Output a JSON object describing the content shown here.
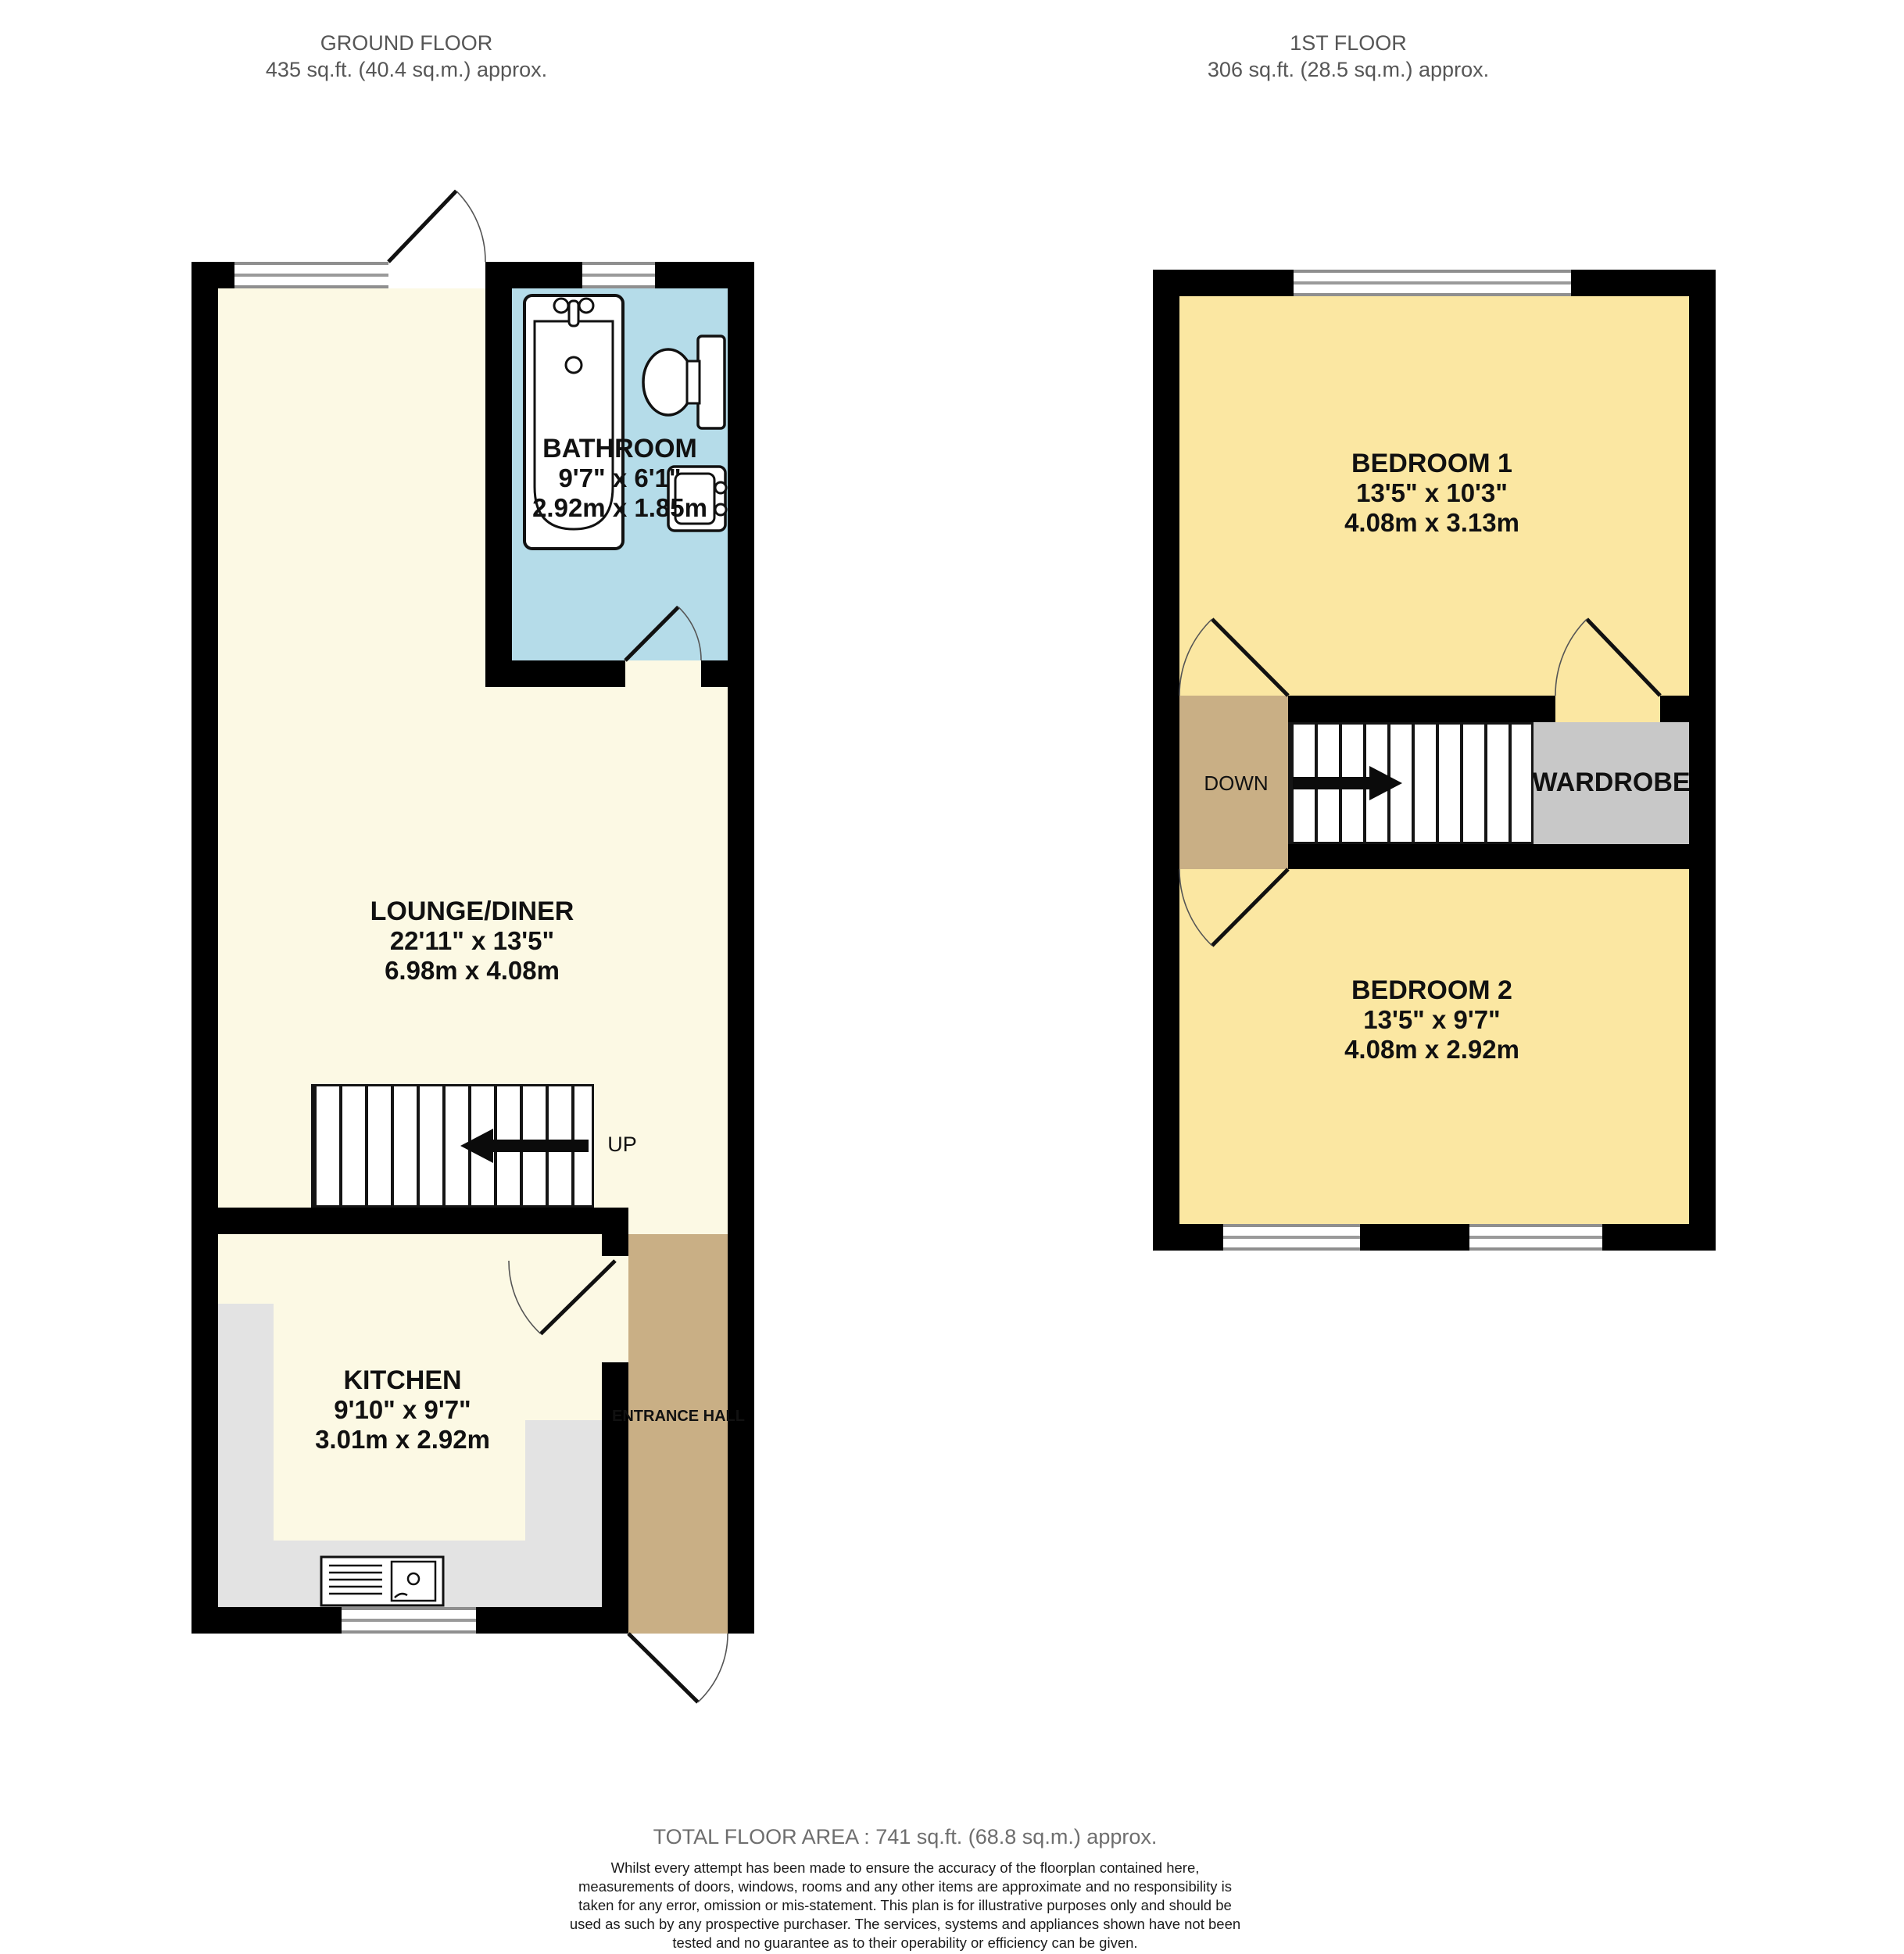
{
  "floors": {
    "ground": {
      "title": "GROUND FLOOR",
      "subtitle": "435 sq.ft. (40.4 sq.m.) approx."
    },
    "first": {
      "title": "1ST FLOOR",
      "subtitle": "306 sq.ft. (28.5 sq.m.) approx."
    }
  },
  "rooms": {
    "bathroom": {
      "name": "BATHROOM",
      "imperial": "9'7\" x 6'1\"",
      "metric": "2.92m x 1.85m"
    },
    "lounge": {
      "name": "LOUNGE/DINER",
      "imperial": "22'11\" x 13'5\"",
      "metric": "6.98m x 4.08m"
    },
    "kitchen": {
      "name": "KITCHEN",
      "imperial": "9'10\" x 9'7\"",
      "metric": "3.01m x 2.92m"
    },
    "bedroom1": {
      "name": "BEDROOM 1",
      "imperial": "13'5\" x 10'3\"",
      "metric": "4.08m x 3.13m"
    },
    "bedroom2": {
      "name": "BEDROOM 2",
      "imperial": "13'5\" x 9'7\"",
      "metric": "4.08m x 2.92m"
    },
    "entrance_hall": {
      "name": "ENTRANCE HALL"
    },
    "wardrobe": {
      "name": "WARDROBE"
    }
  },
  "labels": {
    "up": "UP",
    "down": "DOWN"
  },
  "footer": {
    "total": "TOTAL FLOOR AREA : 741 sq.ft. (68.8 sq.m.) approx.",
    "disclaimer": "Whilst every attempt has been made to ensure the accuracy of the floorplan contained here, measurements of doors, windows, rooms and any other items are approximate and no responsibility is taken for any error, omission or mis-statement. This plan is for illustrative purposes only and should be used as such by any prospective purchaser. The services, systems and appliances shown have not been tested and no guarantee as to their operability or efficiency can be given.",
    "credit": "Made with Metropix ©2025"
  },
  "colors": {
    "wall": "#000000",
    "lounge": "#FCF9E4",
    "bedroom": "#FBE7A2",
    "bathroom": "#B5DCE9",
    "hall": "#C9AF85",
    "wardrobe": "#C8C8C8",
    "counter": "#E3E3E3",
    "header": "#565656",
    "text": "#111111"
  }
}
